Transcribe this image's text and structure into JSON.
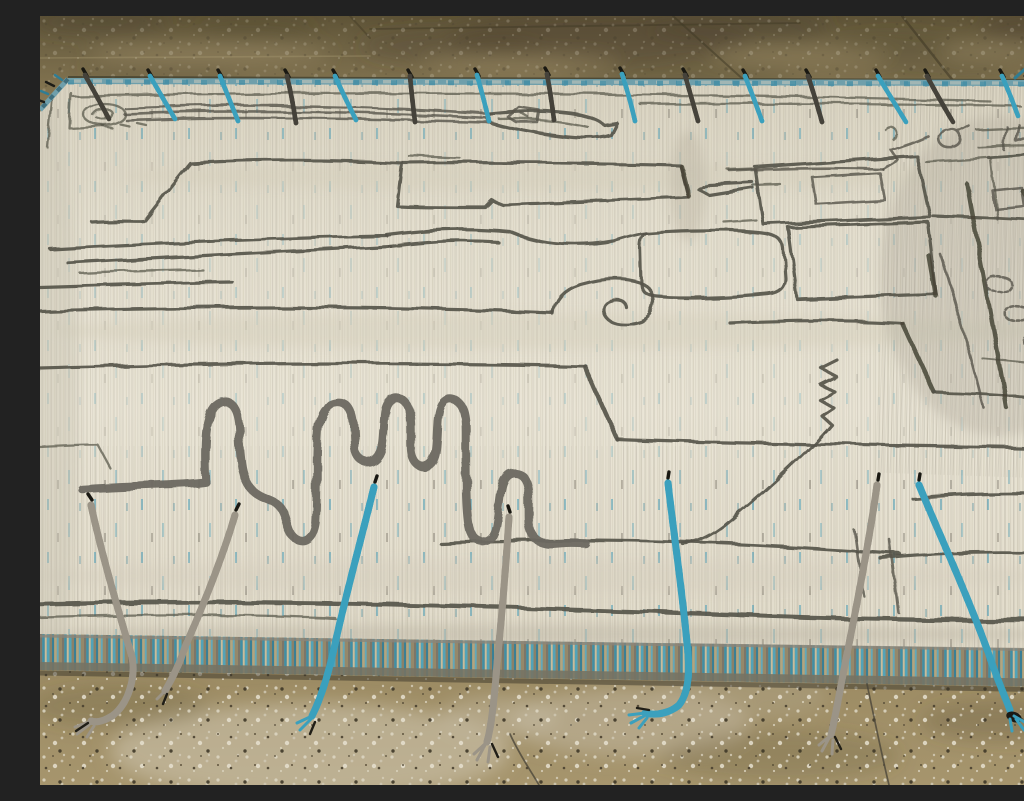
{
  "scene": {
    "type": "photograph",
    "description": "A large cream handwoven Moroccan-style wool rug seen at a low oblique angle on a speckled tan concrete floor. The ivory field is drawn over with thin charcoal abstract motifs: a looped pen-like cartouche along the top border, open rectangles and nested boxes, a spiral scroll, long horizontal abrash lines, a tall serpentine meander, zigzag steps and small leaf loops near the right edge. Teal-blue flecks run through the pile. Short blue-and-black braided fringes lie over the top edge, and seven long braided tassels (teal-and-black or gray-and-black) drape across the striped teal bottom selvedge onto the floor.",
    "setting": "speckled concrete showroom floor with joint seams and mottled stains",
    "perspective": "low oblique angle, rug recedes toward the top of the frame"
  },
  "photo": {
    "width_px": 1024,
    "height_px": 769
  },
  "rug": {
    "field_color_name": "ivory / cream",
    "line_color_name": "charcoal gray",
    "accent_color_name": "teal blue",
    "motifs": [
      "looped cartouche with long trailing lines",
      "small pentagon blob",
      "large open rectangle",
      "elongated wavy blob",
      "nested rectangles",
      "spiral scroll",
      "serpentine meander",
      "vertical zigzag with long diagonal",
      "46-like scribble",
      "small dotted leaf loops on right edge",
      "long horizontal abrash lines"
    ],
    "selvedge": {
      "top": "thin pale teal band",
      "bottom": "wide band striped teal, tan, cream and gray"
    },
    "fringe": {
      "top_braids": 15,
      "bottom_tassels": 7,
      "braid_styles": [
        "teal-and-black braid",
        "gray-and-black braid"
      ]
    }
  },
  "floor": {
    "material": "concrete with terrazzo-like speckle",
    "top_tone": "dark olive brown",
    "bottom_tone": "warm tan with white speckles and pale stains",
    "features": [
      "horizontal joint seam",
      "two diagonal joint seams",
      "pale worn patches"
    ]
  },
  "palette": {
    "cream": "#e7e2d2",
    "creamDark": "#d8d2c0",
    "line": "#56544a",
    "meander": "#6b6960",
    "teal": "#3ba0bd",
    "tealDeep": "#2e7b94",
    "braidGray": "#9b9487",
    "selvGray": "#767364",
    "floorOlive": "#74684a",
    "floorTan": "#a3916b",
    "floorDark": "#463d2a",
    "speckle": "#dcd6c4"
  }
}
